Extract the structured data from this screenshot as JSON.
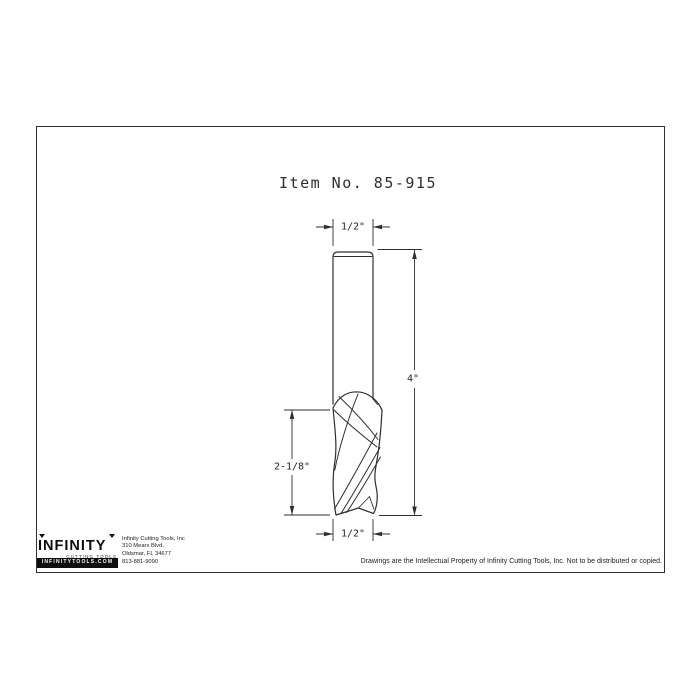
{
  "title": "Item No. 85-915",
  "drawing": {
    "dim_top_width": "1/2\"",
    "dim_overall_length": "4\"",
    "dim_flute_length": "2-1/8\"",
    "dim_bottom_width": "1/2\""
  },
  "footer": {
    "logo_text": "INFINITY",
    "logo_subtext": "CUTTING TOOLS",
    "logo_bar": "INFINITYTOOLS.COM",
    "company": "Infinity Cutting Tools, Inc",
    "address_line1": "310 Mears Blvd.",
    "address_line2": "Oldsmar, FL  34677",
    "phone": "813-881-9090",
    "copyright": "Drawings are the Intellectual Property of Infinity Cutting Tools, Inc. Not to be distributed or copied."
  },
  "colors": {
    "line": "#2f2f2f",
    "border": "#2e2e2e",
    "background": "#ffffff"
  }
}
